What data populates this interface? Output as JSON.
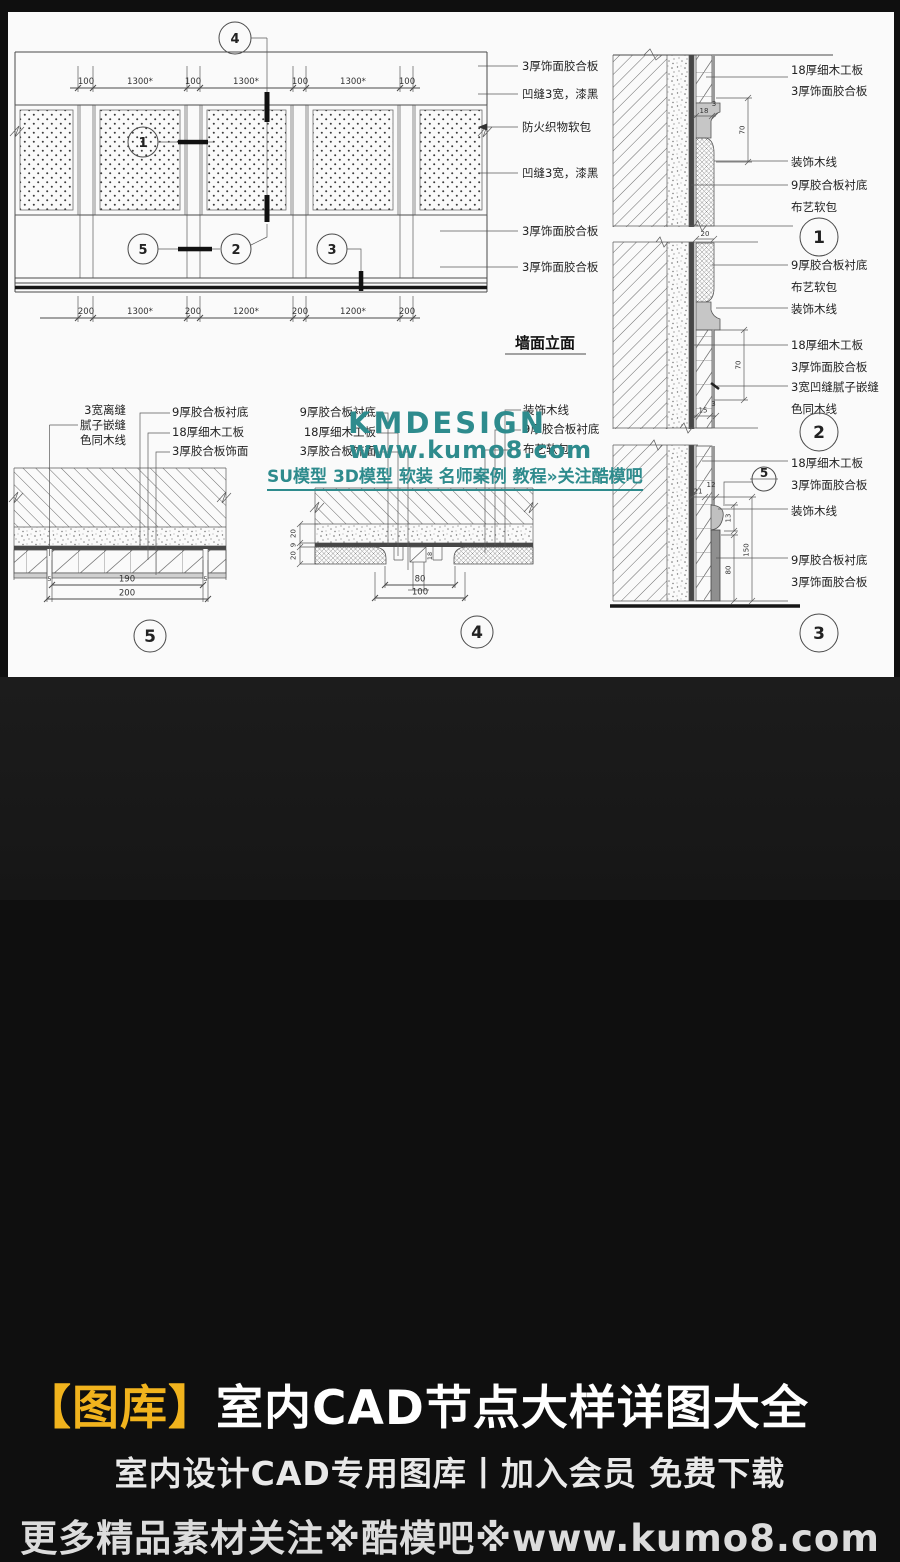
{
  "elevation": {
    "title": "墙面立面",
    "dims_top": [
      "100",
      "1300*",
      "100",
      "1300*",
      "100",
      "1300*",
      "100"
    ],
    "dims_bottom": [
      "200",
      "1300*",
      "200",
      "1200*",
      "200",
      "1200*",
      "200"
    ],
    "callout_top": "4",
    "callout_panel": "1",
    "callout_row": [
      "5",
      "2",
      "3"
    ],
    "notes": [
      "3厚饰面胶合板",
      "凹缝3宽，漆黑",
      "防火织物软包",
      "凹缝3宽，漆黑",
      "3厚饰面胶合板",
      "3厚饰面胶合板"
    ]
  },
  "section": {
    "notes": [
      [
        "18厚细木工板",
        "3厚饰面胶合板"
      ],
      [
        "装饰木线"
      ],
      [
        "9厚胶合板衬底",
        "布艺软包"
      ],
      [
        "9厚胶合板衬底",
        "布艺软包"
      ],
      [
        "装饰木线"
      ],
      [
        "18厚细木工板",
        "3厚饰面胶合板"
      ],
      [
        "3宽凹缝腻子嵌缝",
        "色同木线"
      ],
      [
        "18厚细木工板",
        "3厚饰面胶合板"
      ],
      [
        "装饰木线"
      ],
      [
        "9厚胶合板衬底",
        "3厚饰面胶合板"
      ]
    ],
    "refs": [
      "1",
      "2",
      "3"
    ],
    "cut_ref": "5",
    "dims": {
      "t18": "18",
      "t3": "3",
      "t70": "70",
      "m20": "20",
      "m15": "15",
      "m3": "3",
      "m70": "70",
      "b21": "21",
      "b12": "12",
      "b13": "13",
      "b80": "80",
      "b150": "150"
    }
  },
  "detail5": {
    "ref": "5",
    "note_left": [
      "3宽离缝",
      "腻子嵌缝",
      "色同木线"
    ],
    "notes_right": [
      "9厚胶合板衬底",
      "18厚细木工板",
      "3厚胶合板饰面"
    ],
    "dims": {
      "gap_l": "5",
      "mid": "190",
      "gap_r": "5",
      "total": "200"
    }
  },
  "detail4": {
    "ref": "4",
    "notes_left": [
      "9厚胶合板衬底",
      "18厚细木工板",
      "3厚胶合板饰面"
    ],
    "notes_right": [
      "装饰木线",
      "9厚胶合板衬底",
      "布艺软包"
    ],
    "dims_left": [
      "20",
      "9",
      "20"
    ],
    "dim_inner": "18",
    "dims_bottom": [
      "80",
      "100"
    ]
  },
  "watermark": {
    "brand": "KMDESIGN",
    "site": "www.kumo8.com",
    "tagline": "SU模型 3D模型 软装 名师案例 教程»关注酷模吧",
    "color": "#2e8b8d"
  },
  "banner": {
    "tag": "【图库】",
    "title": "室内CAD节点大样详图大全",
    "subtitle": "室内设计CAD专用图库丨加入会员 免费下载",
    "footer": "更多精品素材关注※酷模吧※www.kumo8.com",
    "tag_color": "#f1b31d",
    "bg": "#1a1a1a"
  }
}
